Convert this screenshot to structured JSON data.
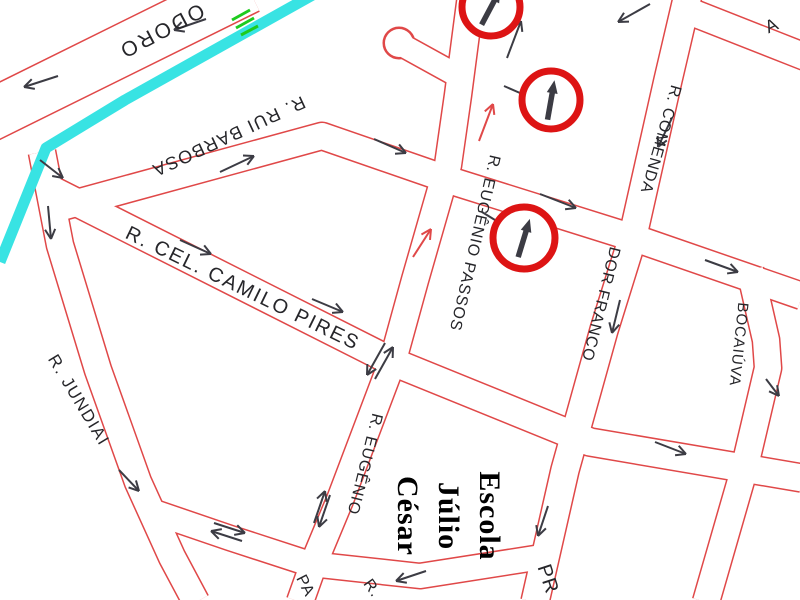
{
  "map": {
    "title_semantic": "street-traffic-map",
    "colors": {
      "road_line": "#e04848",
      "road_fill": "#ffffff",
      "river": "#38e3e3",
      "sign_red": "#dd1414",
      "arrow_dark": "#3c3c44",
      "green": "#1ecb1e",
      "text": "#26262a"
    },
    "street_labels": [
      {
        "id": "doro",
        "text": "ODORO",
        "x": 158,
        "y": 25,
        "rotate": 152,
        "size": 21,
        "spacing": 3
      },
      {
        "id": "rui-barbosa",
        "text": "R. RUI BARBOSA",
        "x": 226,
        "y": 131,
        "rotate": 155,
        "size": 18,
        "spacing": 1.5
      },
      {
        "id": "camilo-pires",
        "text": "R. CEL. CAMILO PIRES",
        "x": 240,
        "y": 294,
        "rotate": 26,
        "size": 20,
        "spacing": 2
      },
      {
        "id": "jundiai",
        "text": "R. JUNDIAI",
        "x": 74,
        "y": 403,
        "rotate": 59,
        "size": 17,
        "spacing": 1.5
      },
      {
        "id": "eugenio-passos",
        "text": "R. EUGÊNIO PASSOS",
        "x": 470,
        "y": 242,
        "rotate": 103,
        "size": 16,
        "spacing": 1
      },
      {
        "id": "eugenio",
        "text": "R. EUGÊNIO",
        "x": 360,
        "y": 463,
        "rotate": 104,
        "size": 16,
        "spacing": 1
      },
      {
        "id": "comenda",
        "text": "R. COMENDA",
        "x": 656,
        "y": 138,
        "rotate": 106,
        "size": 16,
        "spacing": 1
      },
      {
        "id": "dor-franco",
        "text": "DOR FRANCO",
        "x": 596,
        "y": 303,
        "rotate": 104,
        "size": 16,
        "spacing": 1
      },
      {
        "id": "bocaiuva",
        "text": "BOCAIÚVA",
        "x": 734,
        "y": 344,
        "rotate": 96,
        "size": 15,
        "spacing": 1
      },
      {
        "id": "fragment-a",
        "text": "A",
        "x": 774,
        "y": 31,
        "rotate": -25,
        "size": 18,
        "spacing": 0
      },
      {
        "id": "fragment-pa",
        "text": "PA",
        "x": 301,
        "y": 588,
        "rotate": 63,
        "size": 16,
        "spacing": 1
      },
      {
        "id": "fragment-r",
        "text": "R.",
        "x": 368,
        "y": 591,
        "rotate": 55,
        "size": 16,
        "spacing": 1
      },
      {
        "id": "fragment-pr",
        "text": "PR",
        "x": 542,
        "y": 581,
        "rotate": 72,
        "size": 20,
        "spacing": 1,
        "color": "#1ecb1e"
      }
    ],
    "escola": {
      "lines": [
        "Escola",
        "Júlio",
        "César"
      ]
    },
    "signs": [
      {
        "cx": 491,
        "cy": 7,
        "r": 29,
        "arrow_angle": 28
      },
      {
        "cx": 551,
        "cy": 100,
        "r": 29,
        "arrow_angle": 10
      },
      {
        "cx": 524,
        "cy": 238,
        "r": 31,
        "arrow_angle": 17
      }
    ],
    "arrows": [
      {
        "x1": 58,
        "y1": 76,
        "x2": 24,
        "y2": 87,
        "color": "dark",
        "head": true
      },
      {
        "x1": 206,
        "y1": 19,
        "x2": 174,
        "y2": 30,
        "color": "dark",
        "head": true
      },
      {
        "x1": 650,
        "y1": 4,
        "x2": 618,
        "y2": 22,
        "color": "dark",
        "head": true
      },
      {
        "x1": 507,
        "y1": 58,
        "x2": 521,
        "y2": 21,
        "color": "dark",
        "head": true
      },
      {
        "x1": 220,
        "y1": 172,
        "x2": 254,
        "y2": 156,
        "color": "dark",
        "head": true
      },
      {
        "x1": 374,
        "y1": 139,
        "x2": 406,
        "y2": 153,
        "color": "dark",
        "head": true
      },
      {
        "x1": 540,
        "y1": 194,
        "x2": 576,
        "y2": 208,
        "color": "dark",
        "head": true
      },
      {
        "x1": 705,
        "y1": 260,
        "x2": 738,
        "y2": 272,
        "color": "dark",
        "head": true
      },
      {
        "x1": 672,
        "y1": 118,
        "x2": 658,
        "y2": 147,
        "color": "dark",
        "head": true
      },
      {
        "x1": 620,
        "y1": 300,
        "x2": 612,
        "y2": 333,
        "color": "dark",
        "head": true
      },
      {
        "x1": 180,
        "y1": 240,
        "x2": 211,
        "y2": 254,
        "color": "dark",
        "head": true
      },
      {
        "x1": 312,
        "y1": 299,
        "x2": 343,
        "y2": 312,
        "color": "dark",
        "head": true
      },
      {
        "x1": 655,
        "y1": 442,
        "x2": 686,
        "y2": 454,
        "color": "dark",
        "head": true
      },
      {
        "x1": 40,
        "y1": 160,
        "x2": 63,
        "y2": 178,
        "color": "dark",
        "head": true
      },
      {
        "x1": 48,
        "y1": 206,
        "x2": 51,
        "y2": 239,
        "color": "dark",
        "head": true
      },
      {
        "x1": 119,
        "y1": 470,
        "x2": 139,
        "y2": 491,
        "color": "dark",
        "head": true
      },
      {
        "x1": 426,
        "y1": 571,
        "x2": 396,
        "y2": 581,
        "color": "dark",
        "head": true
      },
      {
        "x1": 548,
        "y1": 506,
        "x2": 538,
        "y2": 536,
        "color": "dark",
        "head": true
      },
      {
        "x1": 766,
        "y1": 379,
        "x2": 779,
        "y2": 396,
        "color": "dark",
        "head": true
      },
      {
        "x1": 375,
        "y1": 379,
        "x2": 393,
        "y2": 347,
        "color": "dark",
        "head": true
      },
      {
        "x1": 385,
        "y1": 343,
        "x2": 367,
        "y2": 375,
        "color": "dark",
        "head": true
      },
      {
        "x1": 330,
        "y1": 495,
        "x2": 319,
        "y2": 527,
        "color": "dark",
        "head": true
      },
      {
        "x1": 314,
        "y1": 523,
        "x2": 325,
        "y2": 491,
        "color": "dark",
        "head": true
      },
      {
        "x1": 214,
        "y1": 523,
        "x2": 245,
        "y2": 533,
        "color": "dark",
        "head": true
      },
      {
        "x1": 242,
        "y1": 541,
        "x2": 211,
        "y2": 531,
        "color": "dark",
        "head": true
      },
      {
        "x1": 479,
        "y1": 141,
        "x2": 493,
        "y2": 104,
        "color": "red",
        "head": true
      },
      {
        "x1": 413,
        "y1": 257,
        "x2": 431,
        "y2": 229,
        "color": "red",
        "head": true
      },
      {
        "x1": 504,
        "y1": 86,
        "x2": 520,
        "y2": 93,
        "color": "dark",
        "head": false
      },
      {
        "x1": 482,
        "y1": 212,
        "x2": 495,
        "y2": 220,
        "color": "dark",
        "head": false
      },
      {
        "x1": 512,
        "y1": 2,
        "x2": 534,
        "y2": -8,
        "color": "dark",
        "head": false
      }
    ],
    "river": {
      "points": "318,-8 125,100 46,148 0,262",
      "width": 11
    },
    "green_marks": [
      [
        232,
        20,
        250,
        10
      ],
      [
        236,
        28,
        254,
        18
      ],
      [
        241,
        35,
        258,
        26
      ]
    ]
  }
}
